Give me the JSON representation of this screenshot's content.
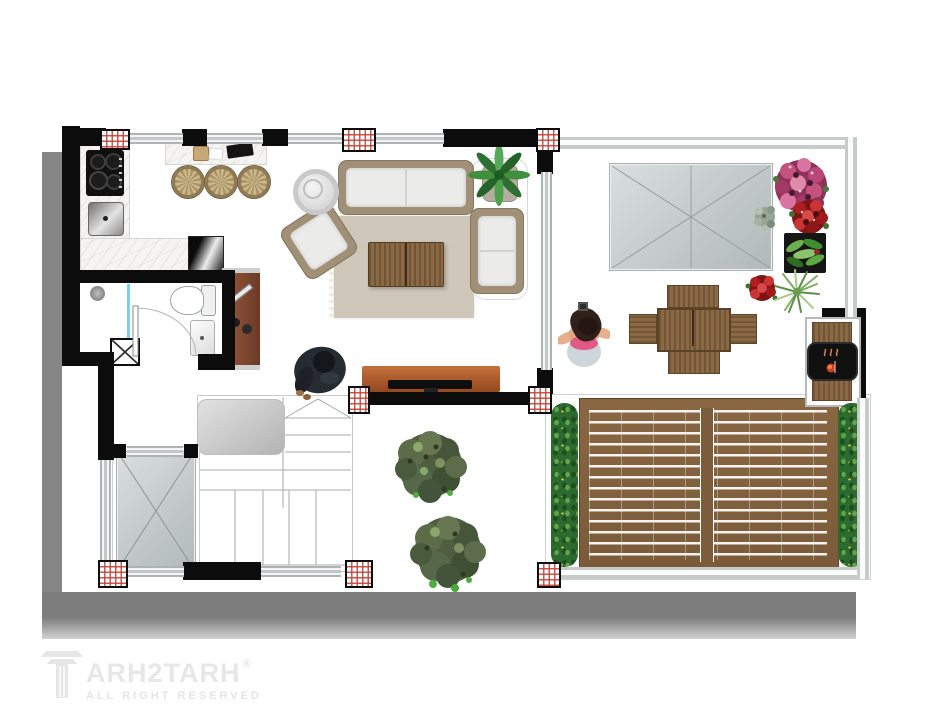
{
  "watermark": {
    "brand": "ARH2TARH",
    "registered": "®",
    "tagline": "ALL RIGHT RESERVED"
  },
  "palette": {
    "background": "#ffffff",
    "drop_shadow": "#7d7d7d",
    "wall": "#0c0c0c",
    "window_glass": "#d9dde0",
    "column_hatch_red": "#c33c30",
    "marble_counter": "#f6f4f2",
    "wicker": "#a09077",
    "cushion_white": "#ebebea",
    "rug_beige": "#cfc8ba",
    "wood": "#8a6a45",
    "tv_console_orange": "#b35a2b",
    "cabinet_brown": "#7a4a33",
    "deck_wood": "#87643f",
    "hedge_green": "#2d6a2d",
    "bush_olive": "#55644a",
    "canopy_gray": "#c4cbcb",
    "grill_black": "#111111",
    "flame_red": "#d33b1f",
    "shower_glass_cyan": "#7fd0e6",
    "watermark_gray": "#e6e6e6"
  },
  "scene": {
    "type": "apartment floor plan, rendered top view",
    "rooms": [
      {
        "name": "kitchen",
        "furniture": [
          "cooktop",
          "sink",
          "l-shaped-marble-counter",
          "refrigerator",
          "breakfast-bar",
          "bar-stools"
        ],
        "bar_stool_count": 3
      },
      {
        "name": "bathroom",
        "furniture": [
          "shower",
          "shower-glass-partition",
          "toilet",
          "washbasin",
          "swing-door",
          "service-shaft"
        ]
      },
      {
        "name": "living-room",
        "furniture": [
          "sofa",
          "armchair",
          "chaise",
          "coffee-table",
          "area-rug",
          "round-side-table",
          "potted-palm",
          "tv-console",
          "tv",
          "beanbag-with-person",
          "display-cabinet"
        ]
      },
      {
        "name": "roof-terrace",
        "furniture": [
          "skylight-canopy",
          "outdoor-dining-table",
          "dining-chairs",
          "standing-person",
          "flower-pots",
          "bbq-grill-station"
        ],
        "dining_chair_count": 4,
        "flower_pot_count": 6
      },
      {
        "name": "wood-deck",
        "furniture": [
          "slatted-deck-floor",
          "hedge-planters"
        ],
        "hedge_planter_count": 2
      },
      {
        "name": "garden-patio",
        "furniture": [
          "round-bushes"
        ],
        "bush_count": 2
      },
      {
        "name": "stair-hall",
        "furniture": [
          "staircase",
          "floor-mat",
          "skylight-void"
        ]
      }
    ]
  }
}
